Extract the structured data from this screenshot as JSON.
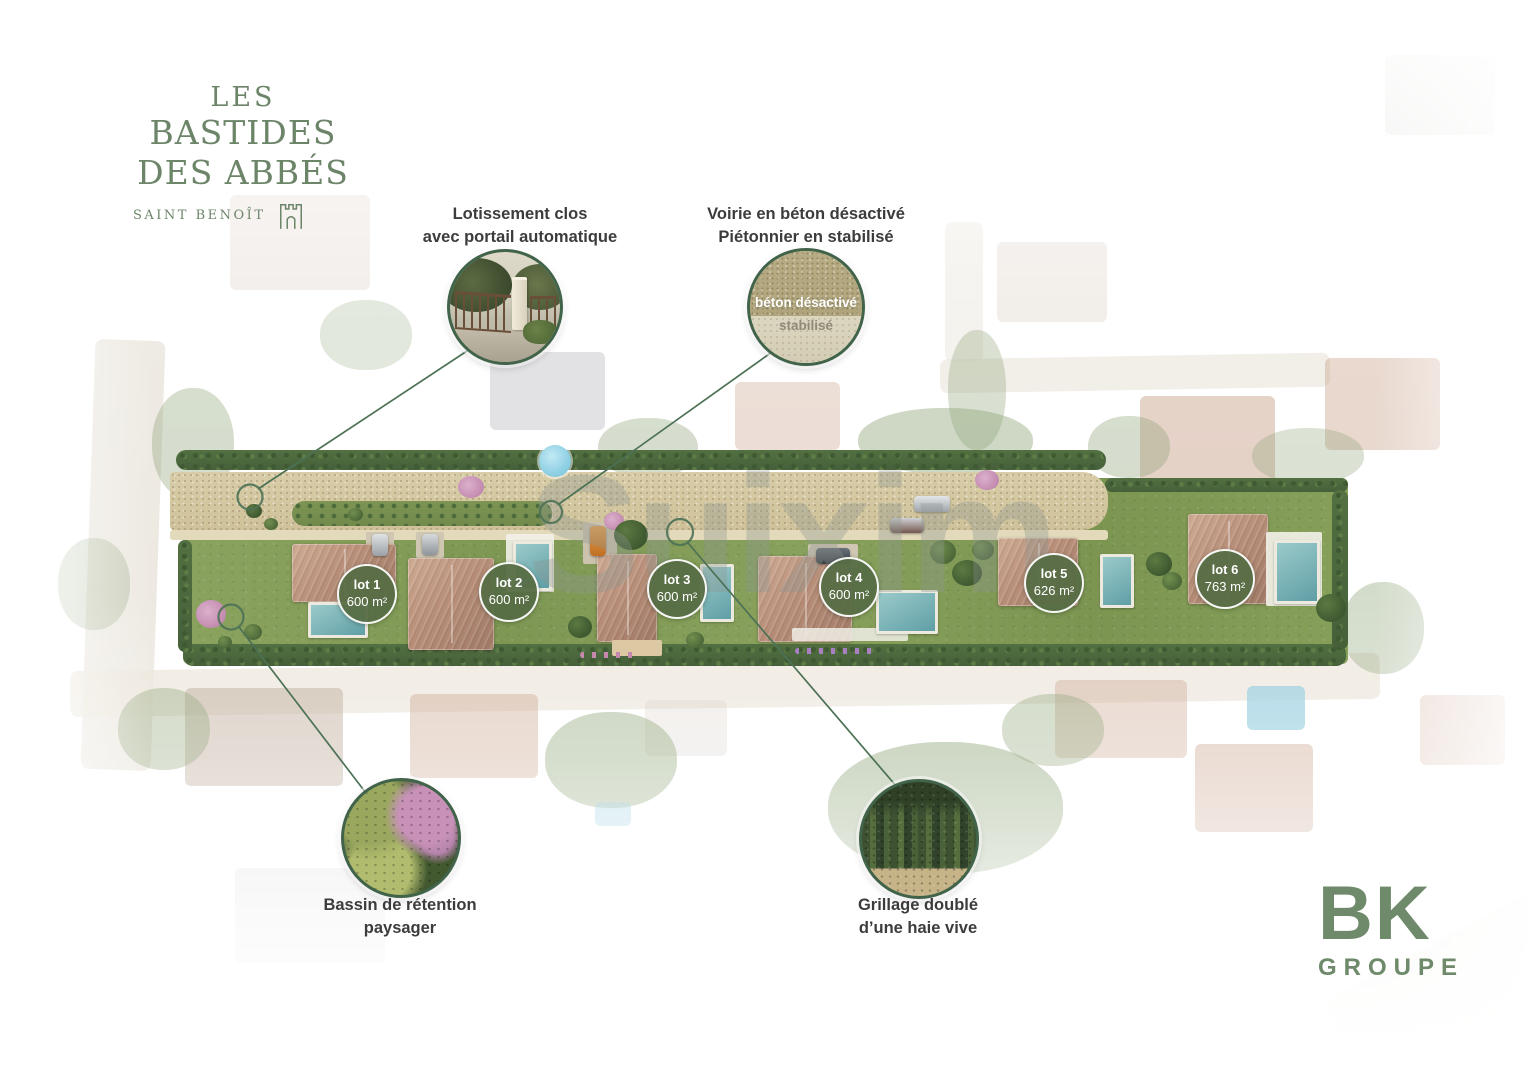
{
  "project": {
    "title_line1": "LES",
    "title_line2": "BASTIDES",
    "title_line3": "DES ABBÉS",
    "subtitle": "SAINT BENOÎT"
  },
  "annotations": {
    "enclosure": {
      "line1": "Lotissement clos",
      "line2": "avec portail automatique"
    },
    "road": {
      "line1": "Voirie en béton désactivé",
      "line2": "Piétonnier en stabilisé",
      "sample_top_label": "béton désactivé",
      "sample_bottom_label": "stabilisé"
    },
    "basin": {
      "line1": "Bassin de rétention",
      "line2": "paysager"
    },
    "fence": {
      "line1": "Grillage doublé",
      "line2": "d’une haie vive"
    }
  },
  "lots": [
    {
      "name": "lot 1",
      "area": "600 m²"
    },
    {
      "name": "lot 2",
      "area": "600 m²"
    },
    {
      "name": "lot 3",
      "area": "600 m²"
    },
    {
      "name": "lot 4",
      "area": "600 m²"
    },
    {
      "name": "lot 5",
      "area": "626 m²"
    },
    {
      "name": "lot 6",
      "area": "763 m²"
    }
  ],
  "watermark": "Suixim",
  "brand": {
    "name": "BK",
    "subtitle": "GROUPE"
  },
  "colors": {
    "brand_green": "#6e8a6a",
    "logo_green": "#6c8569",
    "annotation_circle_border": "#406349",
    "connector_line_green": "#4c7155",
    "lot_badge_green": "#566c44",
    "road_tan": "#d5c9a3",
    "lawn_green": "#849c58"
  }
}
